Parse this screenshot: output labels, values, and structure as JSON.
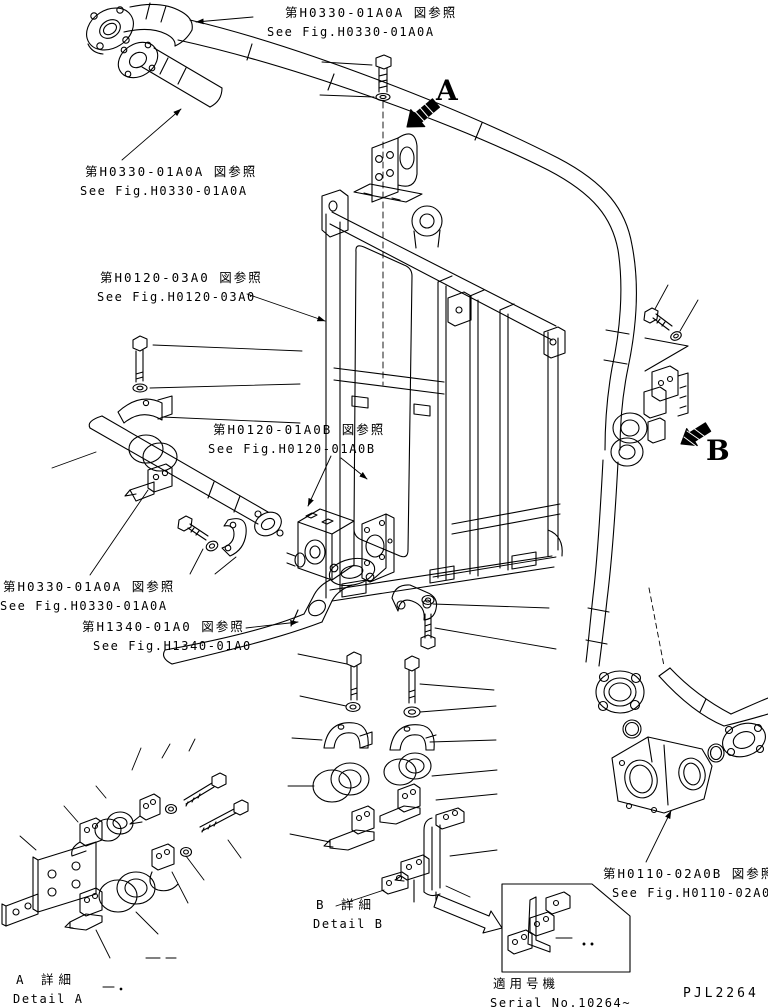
{
  "labels": {
    "ref_top": {
      "jp": "第H0330-01A0A 図参照",
      "en": "See Fig.H0330-01A0A"
    },
    "ref_upper_left": {
      "jp": "第H0330-01A0A 図参照",
      "en": "See Fig.H0330-01A0A"
    },
    "ref_frame": {
      "jp": "第H0120-03A0 図参照",
      "en": "See Fig.H0120-03A0"
    },
    "ref_valve": {
      "jp": "第H0120-01A0B 図参照",
      "en": "See Fig.H0120-01A0B"
    },
    "ref_lower_left": {
      "jp": "第H0330-01A0A 図参照",
      "en": "See Fig.H0330-01A0A"
    },
    "ref_h1340": {
      "jp": "第H1340-01A0 図参照",
      "en": "See Fig.H1340-01A0"
    },
    "ref_h0110": {
      "jp": "第H0110-02A0B 図参照",
      "en": "See Fig.H0110-02A0B"
    },
    "detail_a": {
      "jp": "A 詳細",
      "en": "Detail A"
    },
    "detail_b": {
      "jp": "B 詳細",
      "en": "Detail B"
    },
    "serial": {
      "jp": "適用号機",
      "en": "Serial No.10264~"
    },
    "view_a": "A",
    "view_b": "B",
    "code": "PJL2264"
  },
  "colors": {
    "line": "#000000",
    "background": "#ffffff"
  }
}
